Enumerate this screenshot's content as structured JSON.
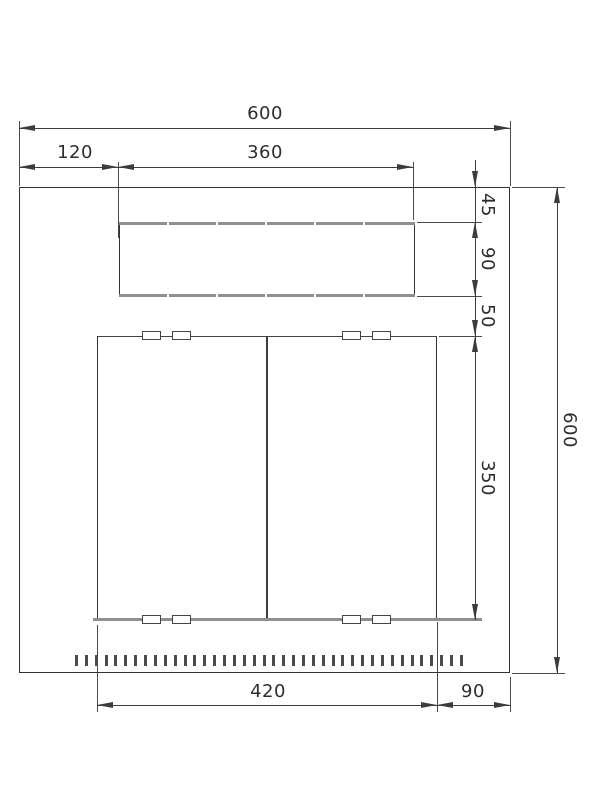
{
  "drawing": {
    "dims": {
      "overall_width": "600",
      "offset_left": "120",
      "top_slot_width": "360",
      "gap_top": "45",
      "top_slot_height": "90",
      "gap_middle": "50",
      "panel_height": "350",
      "overall_height": "600",
      "panel_width": "420",
      "offset_right": "90"
    },
    "features": {
      "top_edge_tick_count": 5,
      "latch_slot_count": 8,
      "perforation_slot_count": 40
    },
    "colors": {
      "line": "#3c3c3c",
      "thick_edge": "#8f8f8f",
      "background": "#ffffff"
    }
  }
}
